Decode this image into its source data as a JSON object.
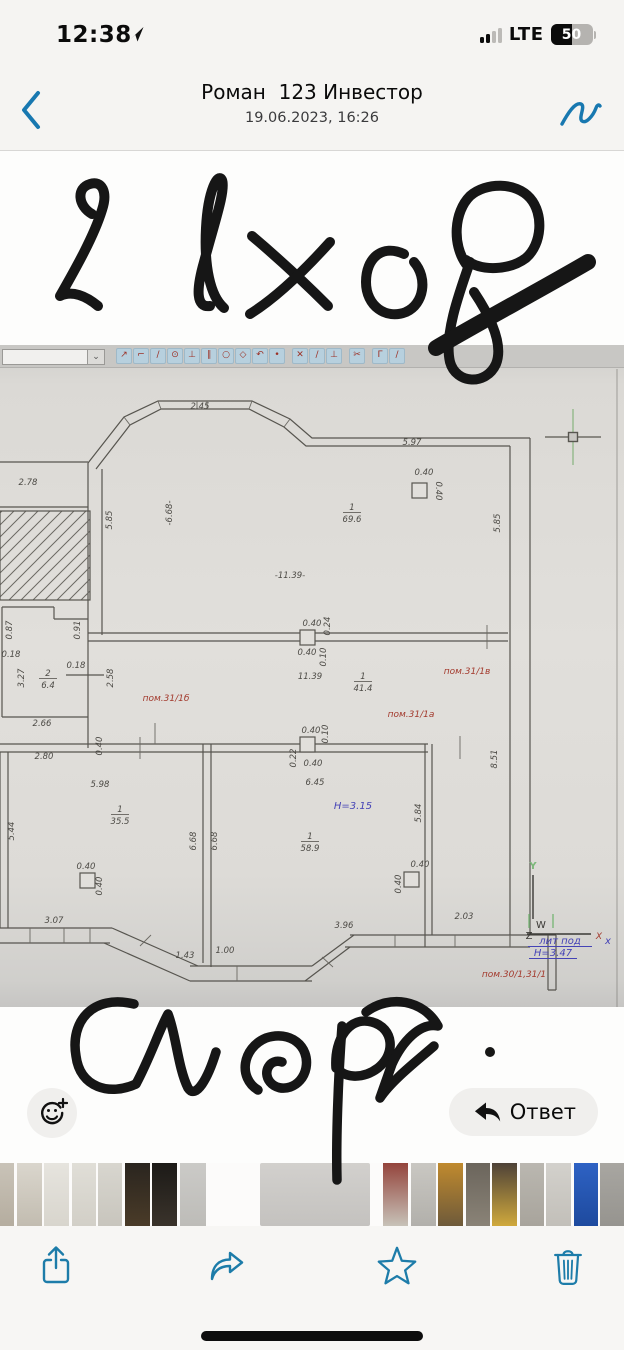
{
  "status_bar": {
    "time": "12:38",
    "network": "LTE",
    "battery_percent": "50",
    "signal_filled_bars": 2,
    "signal_total_bars": 4
  },
  "header": {
    "title": "Роман  123 Инвестор",
    "subtitle": "19.06.2023, 16:26"
  },
  "annotations": {
    "top_text": "2 вход",
    "bottom_text": "Спорт"
  },
  "actions": {
    "reply_label": "Ответ"
  },
  "colors": {
    "accent_blue": "#1878b0",
    "plan_red": "#a33a2d",
    "plan_blue": "#4543b6",
    "plan_green": "#7cb87a",
    "ink_black": "#161616"
  },
  "photo": {
    "cad_toolbar": {
      "icons": [
        {
          "name": "move-node-icon",
          "glyph": "↗"
        },
        {
          "name": "polyline-icon",
          "glyph": "⌐"
        },
        {
          "name": "segment-icon",
          "glyph": "∕"
        },
        {
          "name": "circle-center-icon",
          "glyph": "⊙"
        },
        {
          "name": "perpendicular-icon",
          "glyph": "⊥"
        },
        {
          "name": "parallel-icon",
          "glyph": "∥"
        },
        {
          "name": "circle-icon",
          "glyph": "○"
        },
        {
          "name": "polygon-icon",
          "glyph": "◇"
        },
        {
          "name": "arc-icon",
          "glyph": "↶"
        },
        {
          "name": "point-icon",
          "glyph": "•"
        },
        {
          "sep": true
        },
        {
          "name": "delete-icon",
          "glyph": "✕"
        },
        {
          "name": "trim-icon",
          "glyph": "∕"
        },
        {
          "name": "extend-icon",
          "glyph": "⊥"
        },
        {
          "sep": true
        },
        {
          "name": "cut-icon",
          "glyph": "✂"
        },
        {
          "sep": true
        },
        {
          "name": "corner-icon",
          "glyph": "Γ"
        },
        {
          "name": "measure-icon",
          "glyph": "∕"
        }
      ]
    },
    "floor_plan": {
      "labels": [
        {
          "t": "2.45",
          "x": 200,
          "y": 64
        },
        {
          "t": "5.97",
          "x": 412,
          "y": 100
        },
        {
          "t": "0.40",
          "x": 424,
          "y": 130
        },
        {
          "t": "0.40",
          "x": 436,
          "y": 146,
          "r": 90
        },
        {
          "t": "2.78",
          "x": 28,
          "y": 140
        },
        {
          "t": "5.85",
          "x": 112,
          "y": 175,
          "r": -90
        },
        {
          "t": "-6.68-",
          "x": 172,
          "y": 168,
          "r": -90
        },
        {
          "t": "5.85",
          "x": 500,
          "y": 178,
          "r": -90
        },
        {
          "t": "-11.39-",
          "x": 290,
          "y": 233
        },
        {
          "t": "0.87",
          "x": 12,
          "y": 285,
          "r": -90
        },
        {
          "t": "0.91",
          "x": 80,
          "y": 285,
          "r": -90
        },
        {
          "t": "0.18",
          "x": 11,
          "y": 312
        },
        {
          "t": "0.18",
          "x": 76,
          "y": 323
        },
        {
          "t": "3.27",
          "x": 24,
          "y": 333,
          "r": -90
        },
        {
          "t": "2.58",
          "x": 113,
          "y": 333,
          "r": -90
        },
        {
          "t": "2.66",
          "x": 42,
          "y": 381
        },
        {
          "t": "0.40",
          "x": 312,
          "y": 281
        },
        {
          "t": "0.24",
          "x": 330,
          "y": 281,
          "r": -90
        },
        {
          "t": "0.40",
          "x": 307,
          "y": 310
        },
        {
          "t": "0.10",
          "x": 326,
          "y": 312,
          "r": -90
        },
        {
          "t": "11.39",
          "x": 310,
          "y": 334
        },
        {
          "t": "пом.31/1в",
          "x": 467,
          "y": 329,
          "c": "red"
        },
        {
          "t": "пом.31/1б",
          "x": 166,
          "y": 356,
          "c": "red"
        },
        {
          "t": "пом.31/1а",
          "x": 411,
          "y": 372,
          "c": "red"
        },
        {
          "t": "0.40",
          "x": 102,
          "y": 401,
          "r": -90
        },
        {
          "t": "0.40",
          "x": 311,
          "y": 388
        },
        {
          "t": "0.10",
          "x": 328,
          "y": 389,
          "r": -90
        },
        {
          "t": "0.22",
          "x": 296,
          "y": 413,
          "r": -90
        },
        {
          "t": "0.40",
          "x": 313,
          "y": 421
        },
        {
          "t": "2.80",
          "x": 44,
          "y": 414
        },
        {
          "t": "5.98",
          "x": 100,
          "y": 442
        },
        {
          "t": "5.44",
          "x": 14,
          "y": 486,
          "r": -90
        },
        {
          "t": "6.68",
          "x": 196,
          "y": 496,
          "r": -90
        },
        {
          "t": "6.68",
          "x": 217,
          "y": 496,
          "r": -90
        },
        {
          "t": "6.45",
          "x": 315,
          "y": 440
        },
        {
          "t": "H=3.15",
          "x": 353,
          "y": 464,
          "c": "blue"
        },
        {
          "t": "5.84",
          "x": 421,
          "y": 468,
          "r": -90
        },
        {
          "t": "8.51",
          "x": 497,
          "y": 414,
          "r": -90
        },
        {
          "t": "0.40",
          "x": 86,
          "y": 524
        },
        {
          "t": "0.40",
          "x": 102,
          "y": 541,
          "r": -90
        },
        {
          "t": "0.40",
          "x": 420,
          "y": 522
        },
        {
          "t": "0.40",
          "x": 401,
          "y": 539,
          "r": -90
        },
        {
          "t": "3.07",
          "x": 54,
          "y": 578
        },
        {
          "t": "1.43",
          "x": 185,
          "y": 613
        },
        {
          "t": "1.00",
          "x": 225,
          "y": 608
        },
        {
          "t": "3.96",
          "x": 344,
          "y": 583
        },
        {
          "t": "2.03",
          "x": 464,
          "y": 574
        },
        {
          "t": "Y",
          "x": 533,
          "y": 524,
          "c": "green"
        },
        {
          "t": "W",
          "x": 541,
          "y": 583,
          "c": "dark",
          "s": 11
        },
        {
          "t": "Z",
          "x": 529,
          "y": 594,
          "c": "dark"
        },
        {
          "t": "X",
          "x": 599,
          "y": 594,
          "c": "red",
          "s": 11
        },
        {
          "t": "x",
          "x": 608,
          "y": 599,
          "c": "blue",
          "s": 8
        },
        {
          "t": "лит  под",
          "x": 560,
          "y": 599,
          "c": "blue",
          "u": 64
        },
        {
          "t": "H=3.47",
          "x": 553,
          "y": 611,
          "c": "blue",
          "u": 48
        },
        {
          "t": "пом.30/1,31/1",
          "x": 514,
          "y": 632,
          "c": "red"
        }
      ],
      "fractions": [
        {
          "num": "1",
          "den": "69.6",
          "x": 352,
          "y": 168
        },
        {
          "num": "2",
          "den": "6.4",
          "x": 48,
          "y": 334
        },
        {
          "num": "1",
          "den": "41.4",
          "x": 363,
          "y": 337
        },
        {
          "num": "1",
          "den": "35.5",
          "x": 120,
          "y": 470
        },
        {
          "num": "1",
          "den": "58.9",
          "x": 310,
          "y": 497
        }
      ]
    }
  },
  "thumbnails": {
    "items": [
      {
        "w": 14,
        "c1": "#c9c3b8",
        "c2": "#b5ad9f"
      },
      {
        "w": 25,
        "c1": "#dad6cd",
        "c2": "#c2bcb0"
      },
      {
        "w": 25,
        "c1": "#e6e4de",
        "c2": "#d8d5cd"
      },
      {
        "w": 24,
        "c1": "#e0ded7",
        "c2": "#d2cfc7"
      },
      {
        "w": 24,
        "c1": "#d8d6cf",
        "c2": "#c8c5bd"
      },
      {
        "w": 25,
        "c1": "#2a251f",
        "c2": "#4a3b28"
      },
      {
        "w": 25,
        "c1": "#1c1a17",
        "c2": "#3a332b"
      },
      {
        "w": 26,
        "c1": "#cbcac7",
        "c2": "#bdbcb8"
      },
      {
        "w": 110,
        "c1": "#d2d0cd",
        "c2": "#c4c2bf",
        "selected": true,
        "ml": 52,
        "mr": 13
      },
      {
        "w": 25,
        "c1": "#94443c",
        "c2": "#c7c2b8"
      },
      {
        "w": 25,
        "c1": "#c9c7c2",
        "c2": "#b2b0ab"
      },
      {
        "w": 25,
        "c1": "#c08a2e",
        "c2": "#6e5a3a"
      },
      {
        "w": 24,
        "c1": "#6b655c",
        "c2": "#8a8377"
      },
      {
        "w": 25,
        "c1": "#4e4238",
        "c2": "#d0a93c"
      },
      {
        "w": 24,
        "c1": "#bab7b0",
        "c2": "#a8a49c"
      },
      {
        "w": 25,
        "c1": "#d3d1cc",
        "c2": "#c2bfb9"
      },
      {
        "w": 24,
        "c1": "#2e62c4",
        "c2": "#1e4a9e"
      },
      {
        "w": 28,
        "c1": "#a8a6a1",
        "c2": "#96948f"
      }
    ]
  }
}
